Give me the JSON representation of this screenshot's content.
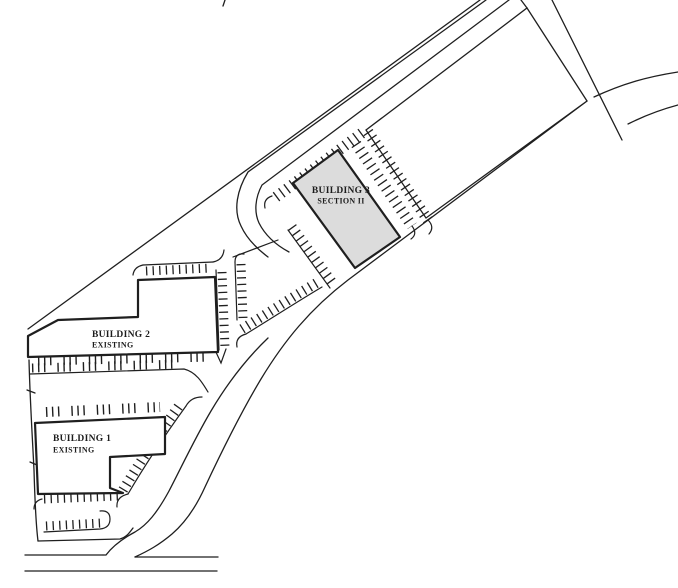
{
  "drawing": {
    "type": "site-plan",
    "background": "#ffffff",
    "ink": "#1f1f1f",
    "fills": {
      "building3": "#dcdcdc",
      "building": "#ffffff",
      "parcel": "#ffffff"
    },
    "labels": {
      "building3_line1": "BUILDING 3",
      "building3_line2": "SECTION II",
      "building2_line1": "BUILDING 2",
      "building2_line2": "EXISTING",
      "building1_line1": "BUILDING 1",
      "building1_line2": "EXISTING"
    }
  }
}
